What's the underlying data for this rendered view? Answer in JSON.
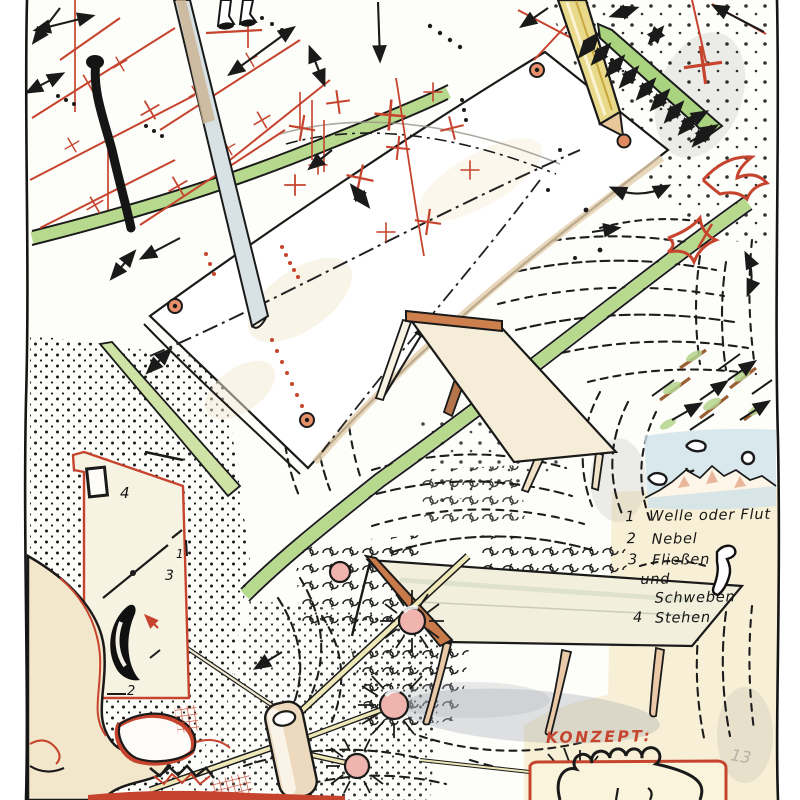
{
  "palette": {
    "paper": "#fbfaf6",
    "ink": "#1a1a1a",
    "red": "#c6442e",
    "green": "#b7d98e",
    "sky_blue": "#cfe2ea",
    "cream": "#f8f0d6",
    "tan": "#e9c9a8",
    "orange": "#cd7f4e",
    "pink": "#eeb0a8",
    "pencil_yellow": "#e9d98a",
    "shadow_gray": "#a8adb5"
  },
  "legend": {
    "items": [
      {
        "num": "1",
        "label": "Welle oder Flut"
      },
      {
        "num": "2",
        "label": "Nebel"
      },
      {
        "num": "3",
        "label": "Fließen"
      },
      {
        "num": "",
        "label": "und"
      },
      {
        "num": "",
        "label": "Schweben"
      },
      {
        "num": "4",
        "label": "Stehen"
      }
    ]
  },
  "plan": {
    "marker_top": "4",
    "marker_mid": "3",
    "marker_edge": "1",
    "marker_bottom": "2",
    "marker_outer": "1"
  },
  "concept": {
    "label": "KONZEPT:"
  },
  "signature": {
    "mark": "13"
  }
}
